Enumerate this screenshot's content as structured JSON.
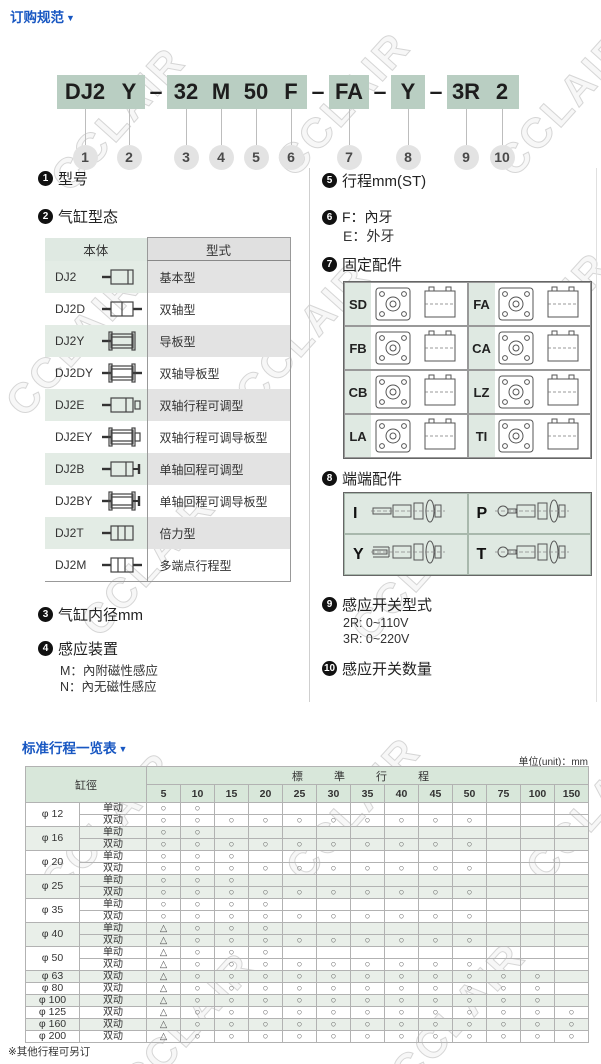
{
  "page": {
    "title": "订购规范",
    "title_marker": "▼",
    "watermark": "CCLAIR"
  },
  "model_code": {
    "segments": [
      {
        "text": "DJ2",
        "num": "1"
      },
      {
        "text": "Y",
        "num": "2"
      },
      {
        "dash": "–"
      },
      {
        "text": "32",
        "num": "3"
      },
      {
        "text": "M",
        "num": "4"
      },
      {
        "text": "50",
        "num": "5"
      },
      {
        "text": "F",
        "num": "6"
      },
      {
        "dash": "–"
      },
      {
        "text": "FA",
        "num": "7"
      },
      {
        "dash": "–"
      },
      {
        "text": "Y",
        "num": "8"
      },
      {
        "dash": "–"
      },
      {
        "text": "3R",
        "num": "9"
      },
      {
        "text": "2",
        "num": "10"
      }
    ]
  },
  "legend_left": {
    "item1": {
      "num": "1",
      "label": "型号"
    },
    "item2": {
      "num": "2",
      "label": "气缸型态"
    },
    "cyl_table": {
      "headers": [
        "本体",
        "型式"
      ],
      "rows": [
        {
          "model": "DJ2",
          "icon": "cylinder-basic-icon",
          "type": "基本型"
        },
        {
          "model": "DJ2D",
          "icon": "cylinder-dual-rod-icon",
          "type": "双轴型"
        },
        {
          "model": "DJ2Y",
          "icon": "cylinder-guided-icon",
          "type": "导板型"
        },
        {
          "model": "DJ2DY",
          "icon": "cylinder-dual-guided-icon",
          "type": "双轴导板型"
        },
        {
          "model": "DJ2E",
          "icon": "cylinder-adjustable-icon",
          "type": "双轴行程可调型"
        },
        {
          "model": "DJ2EY",
          "icon": "cylinder-adjustable-guided-icon",
          "type": "双轴行程可调导板型"
        },
        {
          "model": "DJ2B",
          "icon": "cylinder-return-adjustable-icon",
          "type": "单轴回程可调型"
        },
        {
          "model": "DJ2BY",
          "icon": "cylinder-return-adjustable-guided-icon",
          "type": "单轴回程可调导板型"
        },
        {
          "model": "DJ2T",
          "icon": "cylinder-tandem-icon",
          "type": "倍力型"
        },
        {
          "model": "DJ2M",
          "icon": "cylinder-multi-position-icon",
          "type": "多端点行程型"
        }
      ]
    },
    "item3": {
      "num": "3",
      "label": "气缸内径mm"
    },
    "item4": {
      "num": "4",
      "label": "感应装置",
      "lines": [
        "M：內附磁性感应",
        "N：內无磁性感应"
      ]
    }
  },
  "legend_right": {
    "item5": {
      "num": "5",
      "label": "行程mm(ST)"
    },
    "item6": {
      "num": "6",
      "lines": [
        "F：內牙",
        "E：外牙"
      ]
    },
    "item7": {
      "num": "7",
      "label": "固定配件",
      "mounts": [
        "SD",
        "FA",
        "FB",
        "CA",
        "CB",
        "LZ",
        "LA",
        "TI"
      ]
    },
    "item8": {
      "num": "8",
      "label": "端端配件",
      "ends": [
        "I",
        "P",
        "Y",
        "T"
      ]
    },
    "item9": {
      "num": "9",
      "label": "感应开关型式",
      "lines": [
        "2R: 0~110V",
        "3R: 0~220V"
      ]
    },
    "item10": {
      "num": "10",
      "label": "感应开关数量"
    }
  },
  "stroke_section": {
    "title": "标准行程一览表",
    "marker": "▼",
    "unit_label": "单位(unit)：mm",
    "note": "※其他行程可另订",
    "table": {
      "bore_header": "缸徑",
      "stroke_header": "標 準 行 程",
      "columns": [
        "5",
        "10",
        "15",
        "20",
        "25",
        "30",
        "35",
        "40",
        "45",
        "50",
        "75",
        "100",
        "150"
      ],
      "groups": [
        {
          "bore": "φ 12",
          "tint": false,
          "rows": [
            {
              "action": "单动",
              "marks": [
                "O",
                "O",
                "",
                "",
                "",
                "",
                "",
                "",
                "",
                "",
                "",
                "",
                ""
              ]
            },
            {
              "action": "双动",
              "marks": [
                "O",
                "O",
                "O",
                "O",
                "O",
                "O",
                "O",
                "O",
                "O",
                "O",
                "",
                "",
                ""
              ]
            }
          ]
        },
        {
          "bore": "φ 16",
          "tint": true,
          "rows": [
            {
              "action": "单动",
              "marks": [
                "O",
                "O",
                "",
                "",
                "",
                "",
                "",
                "",
                "",
                "",
                "",
                "",
                ""
              ]
            },
            {
              "action": "双动",
              "marks": [
                "O",
                "O",
                "O",
                "O",
                "O",
                "O",
                "O",
                "O",
                "O",
                "O",
                "",
                "",
                ""
              ]
            }
          ]
        },
        {
          "bore": "φ 20",
          "tint": false,
          "rows": [
            {
              "action": "单动",
              "marks": [
                "O",
                "O",
                "O",
                "",
                "",
                "",
                "",
                "",
                "",
                "",
                "",
                "",
                ""
              ]
            },
            {
              "action": "双动",
              "marks": [
                "O",
                "O",
                "O",
                "O",
                "O",
                "O",
                "O",
                "O",
                "O",
                "O",
                "",
                "",
                ""
              ]
            }
          ]
        },
        {
          "bore": "φ 25",
          "tint": true,
          "rows": [
            {
              "action": "单动",
              "marks": [
                "O",
                "O",
                "O",
                "",
                "",
                "",
                "",
                "",
                "",
                "",
                "",
                "",
                ""
              ]
            },
            {
              "action": "双动",
              "marks": [
                "O",
                "O",
                "O",
                "O",
                "O",
                "O",
                "O",
                "O",
                "O",
                "O",
                "",
                "",
                ""
              ]
            }
          ]
        },
        {
          "bore": "φ 35",
          "tint": false,
          "rows": [
            {
              "action": "单动",
              "marks": [
                "O",
                "O",
                "O",
                "O",
                "",
                "",
                "",
                "",
                "",
                "",
                "",
                "",
                ""
              ]
            },
            {
              "action": "双动",
              "marks": [
                "O",
                "O",
                "O",
                "O",
                "O",
                "O",
                "O",
                "O",
                "O",
                "O",
                "",
                "",
                ""
              ]
            }
          ]
        },
        {
          "bore": "φ 40",
          "tint": true,
          "rows": [
            {
              "action": "单动",
              "marks": [
                "T",
                "O",
                "O",
                "O",
                "",
                "",
                "",
                "",
                "",
                "",
                "",
                "",
                ""
              ]
            },
            {
              "action": "双动",
              "marks": [
                "T",
                "O",
                "O",
                "O",
                "O",
                "O",
                "O",
                "O",
                "O",
                "O",
                "",
                "",
                ""
              ]
            }
          ]
        },
        {
          "bore": "φ 50",
          "tint": false,
          "rows": [
            {
              "action": "单动",
              "marks": [
                "T",
                "O",
                "O",
                "O",
                "",
                "",
                "",
                "",
                "",
                "",
                "",
                "",
                ""
              ]
            },
            {
              "action": "双动",
              "marks": [
                "T",
                "O",
                "O",
                "O",
                "O",
                "O",
                "O",
                "O",
                "O",
                "O",
                "",
                "",
                ""
              ]
            }
          ]
        },
        {
          "bore": "φ 63",
          "tint": true,
          "rows": [
            {
              "action": "双动",
              "marks": [
                "T",
                "O",
                "O",
                "O",
                "O",
                "O",
                "O",
                "O",
                "O",
                "O",
                "O",
                "O",
                ""
              ]
            }
          ]
        },
        {
          "bore": "φ 80",
          "tint": false,
          "rows": [
            {
              "action": "双动",
              "marks": [
                "T",
                "O",
                "O",
                "O",
                "O",
                "O",
                "O",
                "O",
                "O",
                "O",
                "O",
                "O",
                ""
              ]
            }
          ]
        },
        {
          "bore": "φ 100",
          "tint": true,
          "rows": [
            {
              "action": "双动",
              "marks": [
                "T",
                "O",
                "O",
                "O",
                "O",
                "O",
                "O",
                "O",
                "O",
                "O",
                "O",
                "O",
                ""
              ]
            }
          ]
        },
        {
          "bore": "φ 125",
          "tint": false,
          "rows": [
            {
              "action": "双动",
              "marks": [
                "T",
                "O",
                "O",
                "O",
                "O",
                "O",
                "O",
                "O",
                "O",
                "O",
                "O",
                "O",
                "O"
              ]
            }
          ]
        },
        {
          "bore": "φ 160",
          "tint": true,
          "rows": [
            {
              "action": "双动",
              "marks": [
                "T",
                "O",
                "O",
                "O",
                "O",
                "O",
                "O",
                "O",
                "O",
                "O",
                "O",
                "O",
                "O"
              ]
            }
          ]
        },
        {
          "bore": "φ 200",
          "tint": false,
          "rows": [
            {
              "action": "双动",
              "marks": [
                "T",
                "O",
                "O",
                "O",
                "O",
                "O",
                "O",
                "O",
                "O",
                "O",
                "O",
                "O",
                "O"
              ]
            }
          ]
        }
      ]
    }
  }
}
